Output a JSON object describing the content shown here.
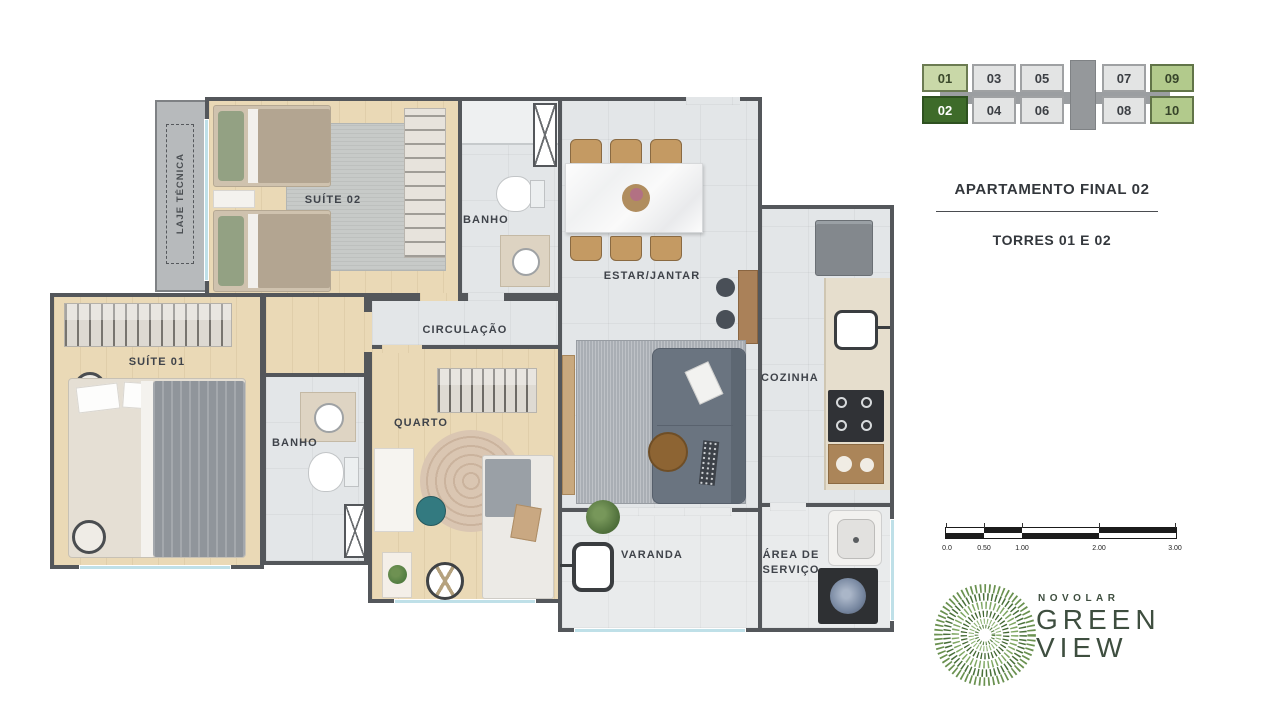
{
  "plan": {
    "rooms": {
      "laje_tecnica": "LAJE TÉCNICA",
      "suite02": "SUÍTE 02",
      "banho_top": "BANHO",
      "estar_jantar": "ESTAR/JANTAR",
      "circulacao": "CIRCULAÇÃO",
      "cozinha": "COZINHA",
      "suite01": "SUÍTE 01",
      "banho_mid": "BANHO",
      "quarto": "QUARTO",
      "varanda": "VARANDA",
      "area_servico": "ÁREA DE SERVIÇO"
    }
  },
  "units": {
    "row_top": [
      "01",
      "03",
      "05",
      "07",
      "09"
    ],
    "row_bottom": [
      "02",
      "04",
      "06",
      "08",
      "10"
    ],
    "selected": "02",
    "colors": {
      "available_light": "#c9d8a8",
      "available_medium": "#b2ca8c",
      "selected": "#3e6b2a",
      "other": "#e3e4e4"
    }
  },
  "info": {
    "title": "APARTAMENTO FINAL 02",
    "subtitle": "TORRES 01 E 02"
  },
  "scale_bar": {
    "labels": [
      "0.0",
      "0.50",
      "1.00",
      "2.00",
      "3.00"
    ]
  },
  "logo": {
    "brand": "NOVOLAR",
    "name_line1": "GREEN",
    "name_line2": "VIEW",
    "accent": "#4a7136"
  }
}
